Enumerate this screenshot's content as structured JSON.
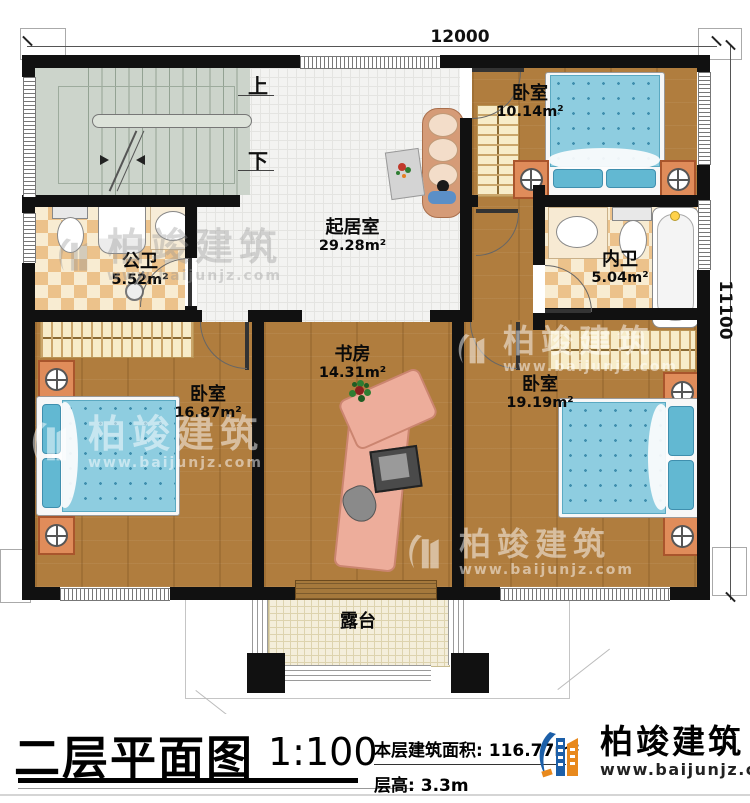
{
  "page": {
    "title": "二层平面图",
    "scale": "1:100",
    "building_area_label": "本层建筑面积:",
    "building_area_value": "116.77m²",
    "floor_height_label": "层高:",
    "floor_height_value": "3.3m"
  },
  "brand": {
    "name": "柏竣建筑",
    "website": "www.baijunjz.com"
  },
  "dimensions": {
    "top_width": "12000",
    "right_height": "11100"
  },
  "stairs": {
    "up_label": "上",
    "down_label": "下"
  },
  "rooms": [
    {
      "name": "卧室",
      "area": "10.14m²"
    },
    {
      "name": "起居室",
      "area": "29.28m²"
    },
    {
      "name": "公卫",
      "area": "5.52m²"
    },
    {
      "name": "内卫",
      "area": "5.04m²"
    },
    {
      "name": "卧室",
      "area": "16.87m²"
    },
    {
      "name": "书房",
      "area": "14.31m²"
    },
    {
      "name": "卧室",
      "area": "19.19m²"
    },
    {
      "name": "露台",
      "area": ""
    }
  ],
  "colors": {
    "wall": "#111111",
    "wood_floor": "#b07d3e",
    "tile_floor": "#f3f3f1",
    "bath_checker": "#ecc28b",
    "stair": "#ccd4cb",
    "terrace": "#f4eedb",
    "bed_blue": "#8ecde0",
    "brand_blue": "#1c5fa8",
    "brand_orange": "#e8891d"
  }
}
